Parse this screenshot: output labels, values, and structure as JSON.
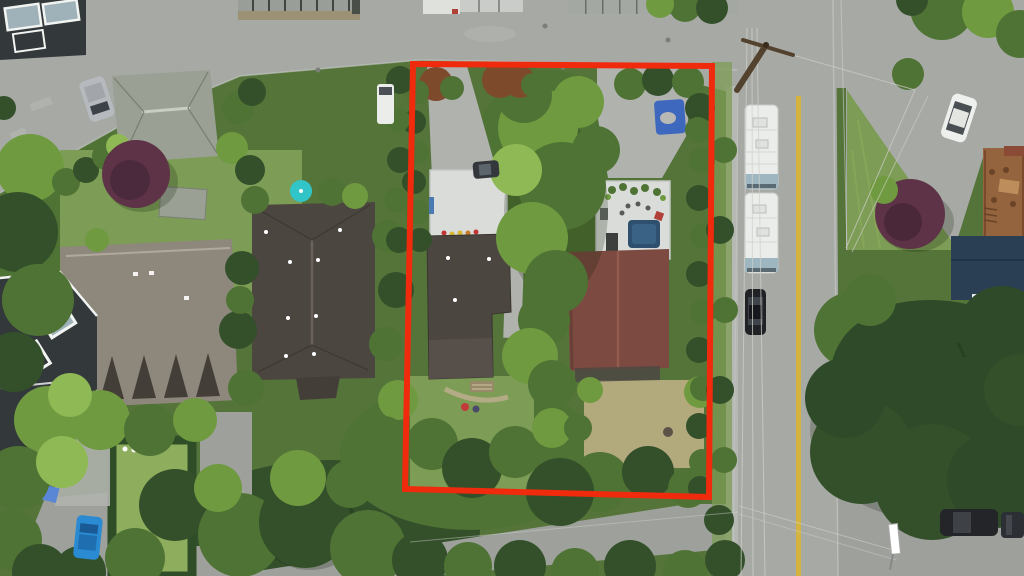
{
  "meta": {
    "type": "aerial-drone-photograph",
    "description": "Overhead drone photo of a residential neighborhood; a red rectangle outlines a subject property containing two houses with rooftop decks, driveways, a large central tree, lawns and a dry back lawn. A vertical road with a yellow center line runs on the right with two parked RVs and a black car; surrounding lots have grey and brown roofed houses, hedges, purple ornamental trees, a large conifer, and parked cars.",
    "width": 1024,
    "height": 576
  },
  "colors": {
    "boundary_red": "#f02a0c",
    "pavement": "#a7a9a5",
    "pavement_light": "#b0b2ae",
    "lane_pavement": "#9da09b",
    "sidewalk": "#b6b8b4",
    "yellow_line": "#d4b43e",
    "lawn": "#7d9c55",
    "lawn_bright": "#8fae5d",
    "lawn_dry": "#b2a97d",
    "tree_dark": "#33502a",
    "tree_mid": "#4f7334",
    "tree_bright": "#6f9a40",
    "tree_lime": "#8fb954",
    "conifer": "#2e4a28",
    "hedge_dark": "#2f4d27",
    "purple_tree": "#5e3347",
    "photinia": "#7d4a2c",
    "roof_dark": "#4c4640",
    "roof_redbrown": "#7c4a41",
    "roof_grey": "#9aa094",
    "roof_taupe": "#8e877b",
    "roof_dormer": "#433e38",
    "modern_dark": "#33383b",
    "glass": "#9fb2ba",
    "trim_white": "#f2f4f2",
    "deck_white": "#d9dcd8",
    "rv_white": "#eaedea",
    "rv_stripe": "#9db6c0",
    "car_white": "#eef0ed",
    "car_black": "#202226",
    "car_blue": "#2a8ad2",
    "car_grey": "#b6babe",
    "car_dark": "#34373c",
    "teal": "#31c5c8",
    "tarp_blue": "#3d68be",
    "deck_brown": "#93643e",
    "navy_roof": "#2b3f54",
    "wire": "#d0d0ca",
    "pole": "#53422e",
    "path": "#b3ab85",
    "white": "#ffffff"
  },
  "landmarks": [
    "property-boundary",
    "subject-lot",
    "subject-house-left",
    "subject-house-right",
    "rooftop-deck-left",
    "rooftop-deck-right",
    "main-road",
    "top-street",
    "rear-lane",
    "white-rv-1",
    "white-rv-2",
    "black-car",
    "white-car",
    "blue-car",
    "grey-van",
    "white-van",
    "power-pole",
    "grass-triangle",
    "purple-tree",
    "large-conifer"
  ]
}
